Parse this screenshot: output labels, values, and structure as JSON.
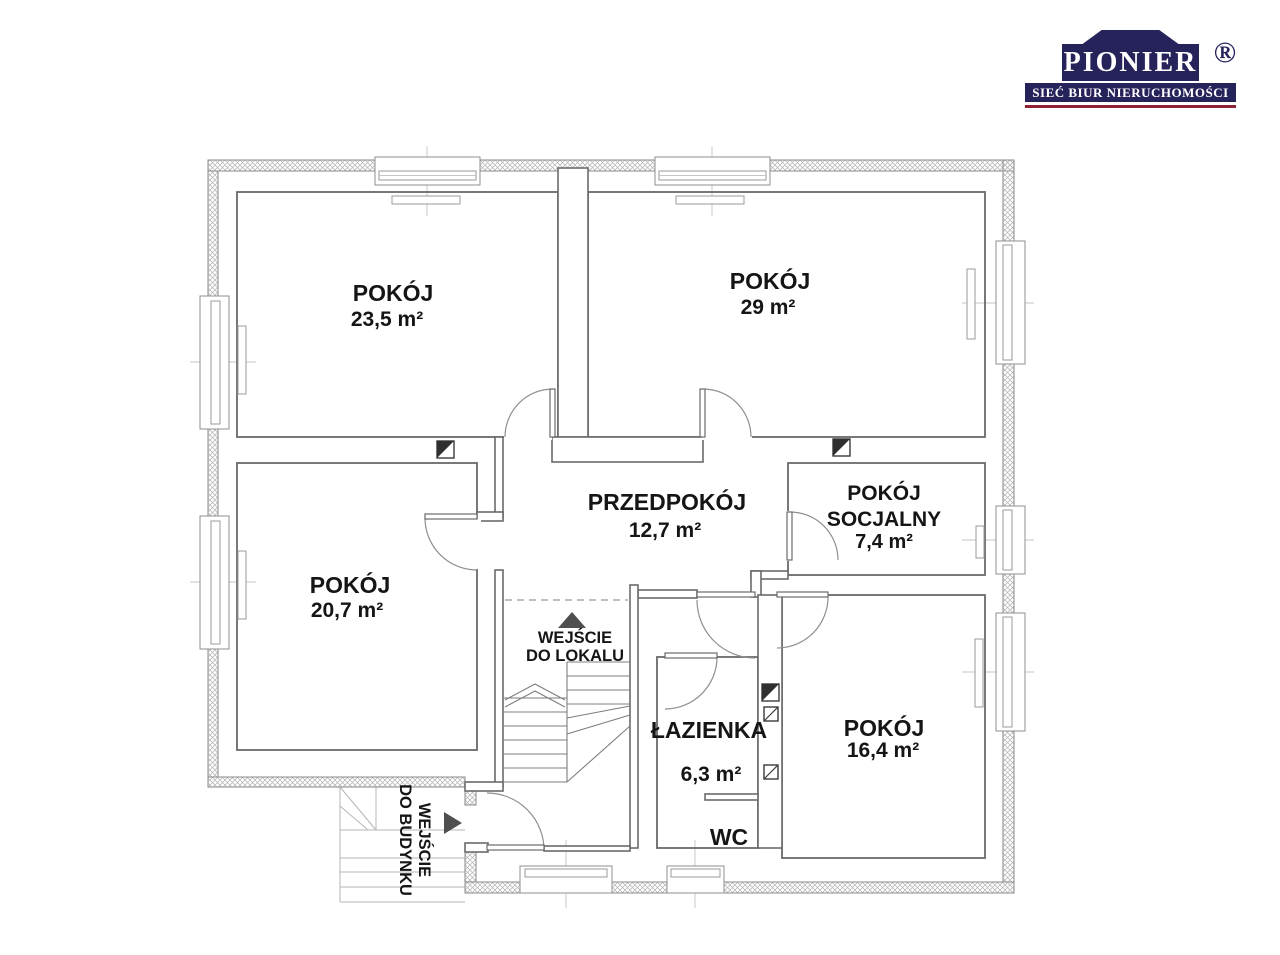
{
  "logo": {
    "brand": "PIONIER",
    "registered": "®",
    "tagline": "SIEĆ BIUR NIERUCHOMOŚCI",
    "navy": "#26235a",
    "maroon": "#8e2038"
  },
  "plan": {
    "rooms": {
      "r1": {
        "name": "POKÓJ",
        "area": "23,5 m²"
      },
      "r2": {
        "name": "POKÓJ",
        "area": "29 m²"
      },
      "r3": {
        "name": "POKÓJ",
        "area": "20,7 m²"
      },
      "hall": {
        "name": "PRZEDPOKÓJ",
        "area": "12,7 m²"
      },
      "social": {
        "name": "POKÓJ",
        "name2": "SOCJALNY",
        "area": "7,4 m²"
      },
      "r4": {
        "name": "POKÓJ",
        "area": "16,4 m²"
      },
      "bath": {
        "name": "ŁAZIENKA",
        "area": "6,3 m²"
      },
      "wc": {
        "name": "WC"
      }
    },
    "entrances": {
      "unit": {
        "line1": "WEJŚCIE",
        "line2": "DO LOKALU"
      },
      "building": {
        "line1": "WEJŚCIE",
        "line2": "DO BUDYNKU"
      }
    }
  }
}
